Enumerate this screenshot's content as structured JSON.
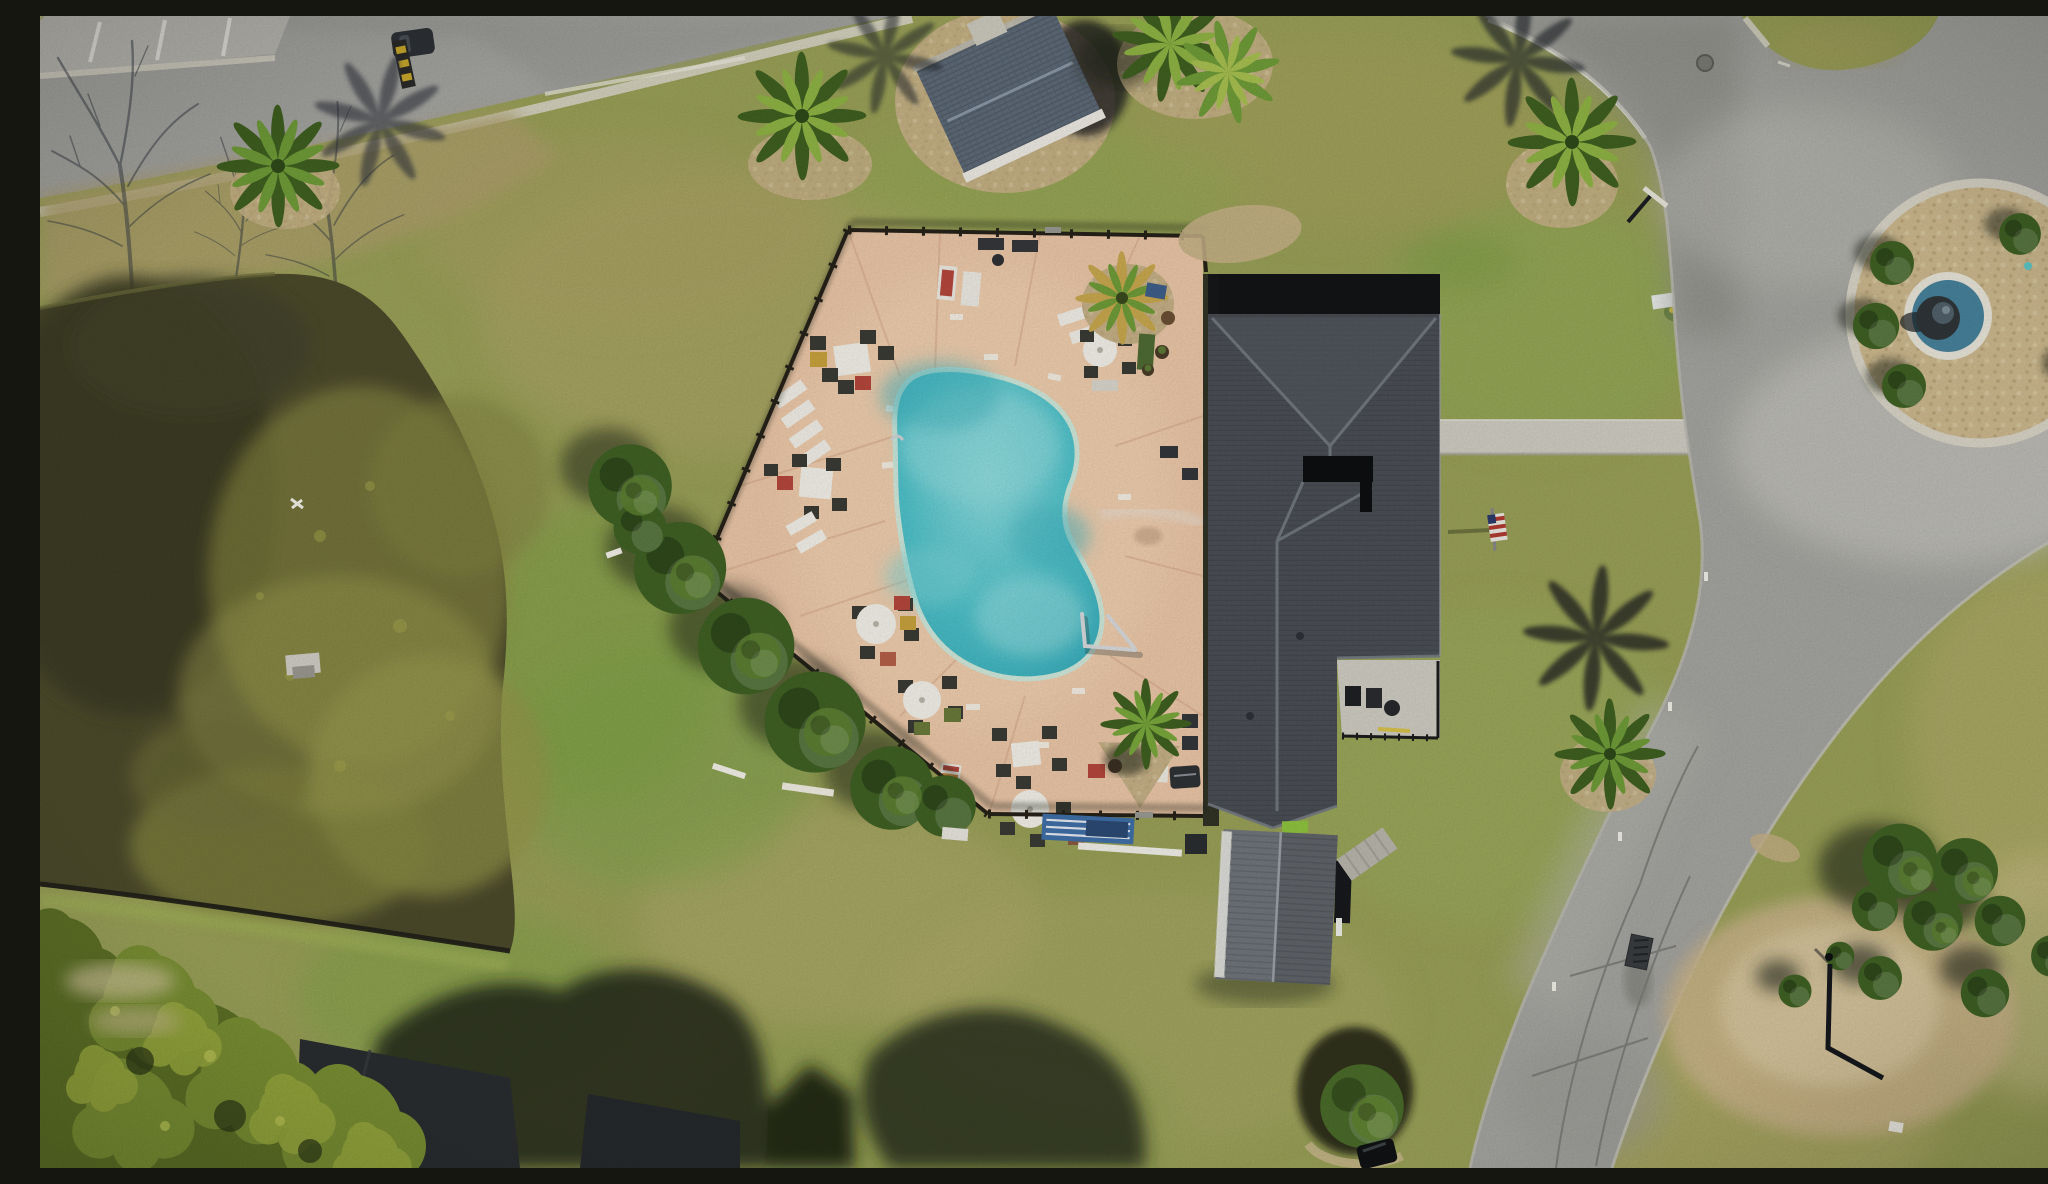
{
  "scene": {
    "domain": "Natural-Image",
    "kind": "aerial-drone-photograph",
    "subject": "Top-down drone photo of a community clubhouse with a kidney-shaped swimming pool on a fenced pink concrete deck, a pond with algae at left, mottled lawns, a curving asphalt street with a circular fountain island at right, palms, patio furniture and tree shadows",
    "lighting": "midday sun, long shadows cast toward the north / upper-left",
    "season": "late winter - dormant yellow-green turf, bare hardwood shadows, green palms"
  },
  "palette": {
    "grassBase": "#99a057",
    "grassGreen": "#7da44a",
    "grassDry": "#b4aa6a",
    "roadAsphalt": "#a4a4a0",
    "roadLight": "#c3c2bb",
    "roadDark": "#8b8b86",
    "curb": "#d8d5c7",
    "pond": "#4b4a2b",
    "pondDark": "#3c3b22",
    "algae": "#8d8e45",
    "deck": "#ebc6a7",
    "deckJoint": "#d8ab8b",
    "poolAqua": "#4fc2ca",
    "poolLight": "#8fdcdd",
    "poolCoping": "#cfe8da",
    "fence": "#262219",
    "roofMain": "#4b4f55",
    "roofRidge": "#767c84",
    "roofBlack": "#131416",
    "gazeboRoof": "#5d6a78",
    "shedRoof": "#70757b",
    "bushGreen": "#3f6124",
    "bushLight": "#5c8030",
    "palmGreen": "#6f9c38",
    "palmDark": "#3f6020",
    "shadow": "#1d2316",
    "rockBed": "#c5b086",
    "pebble": "#ccb88e",
    "sand": "#c9b389",
    "white": "#f2f0e8",
    "red": "#b5473c",
    "yellow": "#c8a23c",
    "blue": "#3e5f8a",
    "flagRed": "#b03a30",
    "fountainWater": "#47829b",
    "concrete": "#cfccc2"
  },
  "objects": [
    {
      "id": "street-top-left",
      "label": "Asphalt street crossing the top-left corner with parking apron, white stall lines, parked car, yellow-striped speed bump and bare-tree shadows"
    },
    {
      "id": "pond",
      "label": "Irregular pond with dark water and yellow-green algae mats, small dock on the north bank"
    },
    {
      "id": "pool-deck",
      "label": "Pink concrete pool deck, pentagon shaped, enclosed by black aluminum fence"
    },
    {
      "id": "pool",
      "label": "Kidney / bean shaped turquoise swimming pool with white coping and stainless handrail at the south-east end"
    },
    {
      "id": "clubhouse",
      "label": "Large clubhouse with charcoal shingle hip roof, roof valleys, black courtyard cutout and shadowed north band"
    },
    {
      "id": "gazebo",
      "label": "Small blue-grey gabled pool house ringed by a rock bed, north of the deck"
    },
    {
      "id": "shed",
      "label": "Grey ribbed storage shed south of the clubhouse"
    },
    {
      "id": "patio",
      "label": "Covered patio notch at the clubhouse south-east corner with grill chairs and black railing"
    },
    {
      "id": "walkway",
      "label": "Concrete walkway from clubhouse east side to the street"
    },
    {
      "id": "flag",
      "label": "United States flag on a pole in the east lawn"
    },
    {
      "id": "fountain-island",
      "label": "Circular cul-de-sac island: concrete ring, pebble bed, five clipped shrub balls and a round blue fountain basin"
    },
    {
      "id": "street-right",
      "label": "Curving asphalt street sweeping from the top edge around the fountain and down to the bottom edge, with cracks, storm drain and manhole"
    },
    {
      "id": "umbrella-tables",
      "label": "White round umbrella tables with dark chairs and red, yellow and olive cushions along the west fence"
    },
    {
      "id": "square-tables",
      "label": "White square dining tables with dark mesh chairs on the north-west deck"
    },
    {
      "id": "loungers",
      "label": "Stacked white sun loungers on the west edge and red-cushion loungers near the north fence"
    },
    {
      "id": "deck-palms",
      "label": "Potted palms in rock planters on the deck, one near the north-east corner and one in a gravel triangle near the building"
    },
    {
      "id": "grill",
      "label": "Black barbecue grill with white side table near the clubhouse wall"
    },
    {
      "id": "pool-equipment",
      "label": "Blue and white pool furniture stack and long white pipes outside the south fence"
    },
    {
      "id": "fence-bushes",
      "label": "Row of rounded evergreen bushes shading the outside of the south-west fence"
    },
    {
      "id": "palm-northwest",
      "label": "Cabbage palm on the lawn near the street with shadow thrown onto the pavement"
    },
    {
      "id": "palm-east",
      "label": "Cabbage palm between clubhouse and street, shadow cast up-left across the road edge"
    },
    {
      "id": "palm-southeast",
      "label": "Palm in a rock bed beside the lower street with long northward shadow"
    },
    {
      "id": "shrub-beds-southeast",
      "label": "Clipped shrub balls, sandy bed and L-shaped pipe border east of the lower street"
    },
    {
      "id": "shrub-circle-south",
      "label": "Round shrub in a shadowed circular bed near the bottom edge with dark vehicle"
    },
    {
      "id": "houses-bottom",
      "label": "Charcoal house roofs, pale driveway and dense tree canopy along the bottom-left edge"
    },
    {
      "id": "tree-shadows-bottom",
      "label": "Large oak canopy shadow spilling north across the south lawn and a gabled house shadow"
    },
    {
      "id": "sign-posts",
      "label": "Small white sign and reflector posts along the street edges"
    },
    {
      "id": "utility-box",
      "label": "White utility box with yellow flowers east of the walkway"
    }
  ]
}
